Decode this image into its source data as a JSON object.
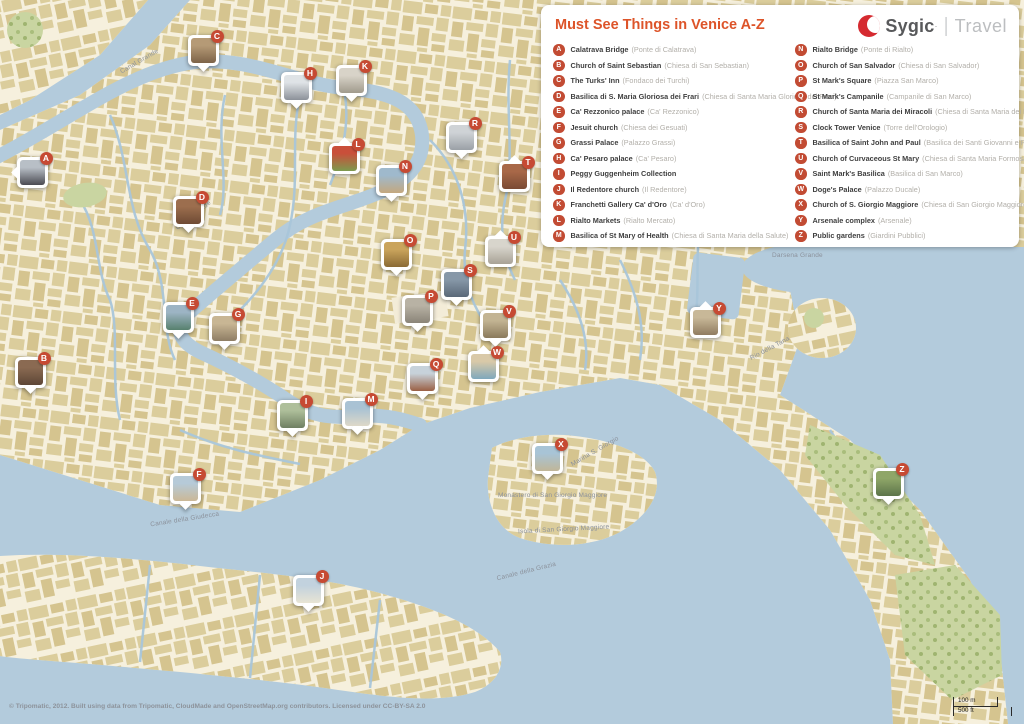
{
  "branding": {
    "logo_text": "Sygic",
    "logo_tm_dot": "·",
    "logo_divider": "|",
    "logo_suffix": "Travel",
    "brand_red": "#d52a30"
  },
  "legend": {
    "title": "Must See Things in Venice A-Z",
    "badge_color": "#c24b33",
    "columns": [
      [
        {
          "letter": "A",
          "name": "Calatrava Bridge",
          "alt": "(Ponte di Calatrava)"
        },
        {
          "letter": "B",
          "name": "Church of Saint Sebastian",
          "alt": "(Chiesa di San Sebastian)"
        },
        {
          "letter": "C",
          "name": "The Turks' Inn",
          "alt": "(Fondaco dei Turchi)"
        },
        {
          "letter": "D",
          "name": "Basilica di S. Maria Gloriosa dei Frari",
          "alt": "(Chiesa di Santa Maria Gloriosa dei Frari)"
        },
        {
          "letter": "E",
          "name": "Ca' Rezzonico palace",
          "alt": "(Ca' Rezzonico)"
        },
        {
          "letter": "F",
          "name": "Jesuit church",
          "alt": "(Chiesa dei Gesuati)"
        },
        {
          "letter": "G",
          "name": "Grassi Palace",
          "alt": "(Palazzo Grassi)"
        },
        {
          "letter": "H",
          "name": "Ca' Pesaro palace",
          "alt": "(Ca' Pesaro)"
        },
        {
          "letter": "I",
          "name": "Peggy Guggenheim Collection",
          "alt": ""
        },
        {
          "letter": "J",
          "name": "Il Redentore church",
          "alt": "(Il Redentore)"
        },
        {
          "letter": "K",
          "name": "Franchetti Gallery Ca' d'Oro",
          "alt": "(Ca' d'Oro)"
        },
        {
          "letter": "L",
          "name": "Rialto Markets",
          "alt": "(Rialto Mercato)"
        },
        {
          "letter": "M",
          "name": "Basilica of St Mary of Health",
          "alt": "(Chiesa di Santa Maria della Salute)"
        }
      ],
      [
        {
          "letter": "N",
          "name": "Rialto Bridge",
          "alt": "(Ponte di Rialto)"
        },
        {
          "letter": "O",
          "name": "Church of San Salvador",
          "alt": "(Chiesa di San Salvador)"
        },
        {
          "letter": "P",
          "name": "St Mark's Square",
          "alt": "(Piazza San Marco)"
        },
        {
          "letter": "Q",
          "name": "St Mark's Campanile",
          "alt": "(Campanile di San Marco)"
        },
        {
          "letter": "R",
          "name": "Church of Santa Maria dei Miracoli",
          "alt": "(Chiesa di Santa Maria dei Miracoli)"
        },
        {
          "letter": "S",
          "name": "Clock Tower Venice",
          "alt": "(Torre dell'Orologio)"
        },
        {
          "letter": "T",
          "name": "Basilica of Saint John and Paul",
          "alt": "(Basilica dei Santi Giovanni e Paolo)"
        },
        {
          "letter": "U",
          "name": "Church of Curvaceous St Mary",
          "alt": "(Chiesa di Santa Maria Formosa)"
        },
        {
          "letter": "V",
          "name": "Saint Mark's Basilica",
          "alt": "(Basilica di San Marco)"
        },
        {
          "letter": "W",
          "name": "Doge's Palace",
          "alt": "(Palazzo Ducale)"
        },
        {
          "letter": "X",
          "name": "Church of S. Giorgio Maggiore",
          "alt": "(Chiesa di San Giorgio Maggiore)"
        },
        {
          "letter": "Y",
          "name": "Arsenale complex",
          "alt": "(Arsenale)"
        },
        {
          "letter": "Z",
          "name": "Public gardens",
          "alt": "(Giardini Pubblici)"
        }
      ]
    ]
  },
  "map": {
    "colors": {
      "water": "#b3cbdc",
      "land": "#f6f0dd",
      "building": "#dbcd9c",
      "building_alt": "#d5c48f",
      "park": "#c9d5a1",
      "canal": "#a9c6da",
      "marker_badge": "#c64a33"
    },
    "markers": [
      {
        "letter": "A",
        "x": 32,
        "y": 172,
        "tail": "left",
        "photo": [
          "#b8bfc6",
          "#4a4a52"
        ]
      },
      {
        "letter": "B",
        "x": 30,
        "y": 372,
        "tail": "bottom",
        "photo": [
          "#8a6a52",
          "#5d4636"
        ]
      },
      {
        "letter": "C",
        "x": 203,
        "y": 50,
        "tail": "bottom",
        "photo": [
          "#b59a76",
          "#7d6348"
        ]
      },
      {
        "letter": "D",
        "x": 188,
        "y": 211,
        "tail": "bottom",
        "photo": [
          "#9c6e4e",
          "#6e4a34"
        ]
      },
      {
        "letter": "E",
        "x": 178,
        "y": 317,
        "tail": "bottom",
        "photo": [
          "#9db4c4",
          "#57806e"
        ]
      },
      {
        "letter": "F",
        "x": 185,
        "y": 488,
        "tail": "bottom",
        "photo": [
          "#b6cad8",
          "#cbb896"
        ]
      },
      {
        "letter": "G",
        "x": 224,
        "y": 328,
        "tail": "bottom",
        "photo": [
          "#c8b694",
          "#8e7d64"
        ]
      },
      {
        "letter": "H",
        "x": 296,
        "y": 87,
        "tail": "bottom",
        "photo": [
          "#dfe3e6",
          "#8c9199"
        ]
      },
      {
        "letter": "I",
        "x": 292,
        "y": 415,
        "tail": "bottom",
        "photo": [
          "#aebf9a",
          "#6f7f62"
        ]
      },
      {
        "letter": "J",
        "x": 308,
        "y": 590,
        "tail": "bottom",
        "photo": [
          "#c2d2de",
          "#e8e4d4"
        ]
      },
      {
        "letter": "K",
        "x": 351,
        "y": 80,
        "tail": "bottom",
        "photo": [
          "#d8d3c8",
          "#a09a8c"
        ]
      },
      {
        "letter": "L",
        "x": 344,
        "y": 158,
        "tail": "top",
        "photo": [
          "#c94f3a",
          "#7d9a4e"
        ]
      },
      {
        "letter": "M",
        "x": 357,
        "y": 413,
        "tail": "bottom",
        "photo": [
          "#a9c2d4",
          "#ded8c8"
        ]
      },
      {
        "letter": "N",
        "x": 391,
        "y": 180,
        "tail": "bottom",
        "photo": [
          "#9fb9cc",
          "#c4a87e"
        ]
      },
      {
        "letter": "O",
        "x": 396,
        "y": 254,
        "tail": "bottom",
        "photo": [
          "#caa45c",
          "#8a6a34"
        ]
      },
      {
        "letter": "P",
        "x": 417,
        "y": 310,
        "tail": "bottom",
        "photo": [
          "#b8b2a4",
          "#8a8478"
        ]
      },
      {
        "letter": "Q",
        "x": 422,
        "y": 378,
        "tail": "bottom",
        "photo": [
          "#c7d2da",
          "#9a5f44"
        ]
      },
      {
        "letter": "R",
        "x": 461,
        "y": 137,
        "tail": "bottom",
        "photo": [
          "#cfd3d6",
          "#9aa0a6"
        ]
      },
      {
        "letter": "S",
        "x": 456,
        "y": 284,
        "tail": "bottom",
        "photo": [
          "#8798a8",
          "#5a6878"
        ]
      },
      {
        "letter": "T",
        "x": 514,
        "y": 176,
        "tail": "top",
        "photo": [
          "#a86848",
          "#7a4a34"
        ]
      },
      {
        "letter": "U",
        "x": 500,
        "y": 251,
        "tail": "top",
        "photo": [
          "#d8d5cc",
          "#a8a296"
        ]
      },
      {
        "letter": "V",
        "x": 495,
        "y": 325,
        "tail": "bottom",
        "photo": [
          "#c3b493",
          "#8a7a5c"
        ]
      },
      {
        "letter": "W",
        "x": 483,
        "y": 366,
        "tail": "top",
        "photo": [
          "#d9c9a8",
          "#7fa8bc"
        ]
      },
      {
        "letter": "X",
        "x": 547,
        "y": 458,
        "tail": "bottom",
        "photo": [
          "#a8c4d6",
          "#c0b698"
        ]
      },
      {
        "letter": "Y",
        "x": 705,
        "y": 322,
        "tail": "top",
        "photo": [
          "#c8b898",
          "#907c60"
        ]
      },
      {
        "letter": "Z",
        "x": 888,
        "y": 483,
        "tail": "bottom",
        "photo": [
          "#8fa668",
          "#5c744a"
        ]
      }
    ],
    "labels": [
      {
        "text": "Canal Grande",
        "x": 118,
        "y": 58,
        "r": -30
      },
      {
        "text": "Canal Grande",
        "x": 172,
        "y": 212,
        "r": -38
      },
      {
        "text": "Canale della Giudecca",
        "x": 150,
        "y": 516,
        "r": -9
      },
      {
        "text": "Canale della Grazia",
        "x": 496,
        "y": 568,
        "r": -14
      },
      {
        "text": "Darsena Grande",
        "x": 772,
        "y": 252,
        "r": 0
      },
      {
        "text": "Rio della Tana",
        "x": 748,
        "y": 345,
        "r": -28
      },
      {
        "text": "Marina S. Giorgio",
        "x": 568,
        "y": 448,
        "r": -30
      },
      {
        "text": "Monastero di San Giorgio Maggiore",
        "x": 498,
        "y": 492,
        "r": 0
      },
      {
        "text": "Isola di San Giorgio Maggiore",
        "x": 518,
        "y": 526,
        "r": -3
      }
    ]
  },
  "footer": {
    "attribution": "© Tripomatic, 2012. Built using data from Tripomatic, CloudMade and OpenStreetMap.org contributors. Licensed under CC-BY-SA 2.0",
    "scale": {
      "metric": "100 m",
      "imperial": "500 ft"
    }
  }
}
